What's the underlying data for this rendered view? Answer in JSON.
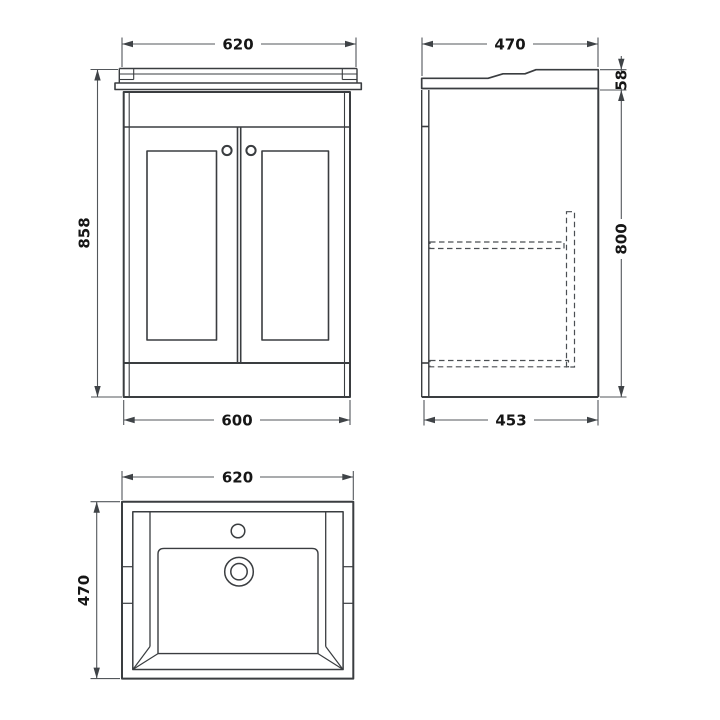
{
  "views": {
    "front": {
      "label": "front-elevation",
      "width_top": "620",
      "height": "858",
      "width_bottom": "600"
    },
    "side": {
      "label": "side-elevation",
      "depth_top": "470",
      "basin_height": "58",
      "cabinet_height": "800",
      "depth_bottom": "453"
    },
    "plan": {
      "label": "basin-plan",
      "width": "620",
      "depth": "470"
    }
  },
  "colors": {
    "object_line": "#3a3d40",
    "dimension_line": "#53575b",
    "text": "#161616",
    "background": "#ffffff"
  }
}
